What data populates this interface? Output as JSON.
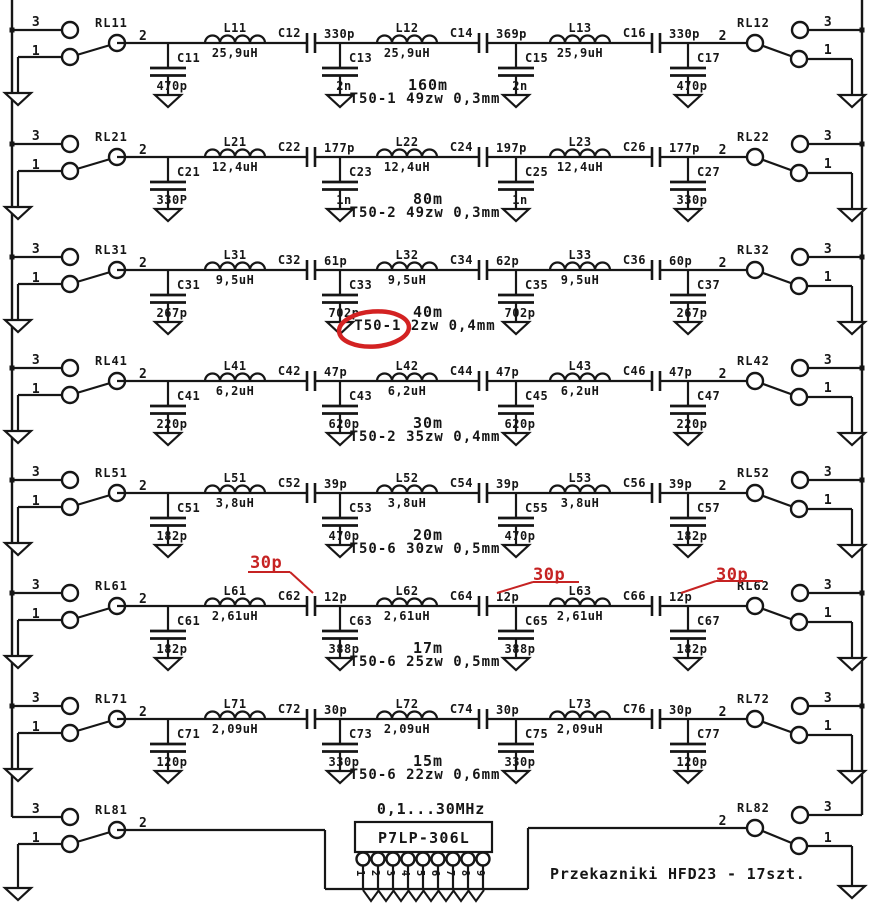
{
  "title": "P7LP-306L 7-band low-pass filter bank schematic",
  "colors": {
    "ink": "#161616",
    "red": "#c62323",
    "background": "#ffffff"
  },
  "relay_pins": {
    "top": "3",
    "common": "2",
    "bottom": "1"
  },
  "rows": [
    {
      "band": "160m",
      "winding": "T50-1 49zw 0,3mm",
      "relay_left": "RL11",
      "relay_right": "RL12",
      "shunt_caps": [
        [
          "C11",
          "470p"
        ],
        [
          "C13",
          "2n"
        ],
        [
          "C15",
          "2n"
        ],
        [
          "C17",
          "470p"
        ]
      ],
      "inductors": [
        [
          "L11",
          "25,9uH"
        ],
        [
          "L12",
          "25,9uH"
        ],
        [
          "L13",
          "25,9uH"
        ]
      ],
      "series_caps": [
        [
          "C12",
          "330p"
        ],
        [
          "C14",
          "369p"
        ],
        [
          "C16",
          "330p"
        ]
      ]
    },
    {
      "band": "80m",
      "winding": "T50-2 49zw 0,3mm",
      "relay_left": "RL21",
      "relay_right": "RL22",
      "shunt_caps": [
        [
          "C21",
          "330P"
        ],
        [
          "C23",
          "1n"
        ],
        [
          "C25",
          "1n"
        ],
        [
          "C27",
          "330p"
        ]
      ],
      "inductors": [
        [
          "L21",
          "12,4uH"
        ],
        [
          "L22",
          "12,4uH"
        ],
        [
          "L23",
          "12,4uH"
        ]
      ],
      "series_caps": [
        [
          "C22",
          "177p"
        ],
        [
          "C24",
          "197p"
        ],
        [
          "C26",
          "177p"
        ]
      ]
    },
    {
      "band": "40m",
      "winding": "T50-1  2zw 0,4mm",
      "relay_left": "RL31",
      "relay_right": "RL32",
      "shunt_caps": [
        [
          "C31",
          "267p"
        ],
        [
          "C33",
          "702p"
        ],
        [
          "C35",
          "702p"
        ],
        [
          "C37",
          "267p"
        ]
      ],
      "inductors": [
        [
          "L31",
          "9,5uH"
        ],
        [
          "L32",
          "9,5uH"
        ],
        [
          "L33",
          "9,5uH"
        ]
      ],
      "series_caps": [
        [
          "C32",
          "61p"
        ],
        [
          "C34",
          "62p"
        ],
        [
          "C36",
          "60p"
        ]
      ]
    },
    {
      "band": "30m",
      "winding": "T50-2 35zw 0,4mm",
      "relay_left": "RL41",
      "relay_right": "RL42",
      "shunt_caps": [
        [
          "C41",
          "220p"
        ],
        [
          "C43",
          "620p"
        ],
        [
          "C45",
          "620p"
        ],
        [
          "C47",
          "220p"
        ]
      ],
      "inductors": [
        [
          "L41",
          "6,2uH"
        ],
        [
          "L42",
          "6,2uH"
        ],
        [
          "L43",
          "6,2uH"
        ]
      ],
      "series_caps": [
        [
          "C42",
          "47p"
        ],
        [
          "C44",
          "47p"
        ],
        [
          "C46",
          "47p"
        ]
      ]
    },
    {
      "band": "20m",
      "winding": "T50-6 30zw 0,5mm",
      "relay_left": "RL51",
      "relay_right": "RL52",
      "shunt_caps": [
        [
          "C51",
          "182p"
        ],
        [
          "C53",
          "470p"
        ],
        [
          "C55",
          "470p"
        ],
        [
          "C57",
          "182p"
        ]
      ],
      "inductors": [
        [
          "L51",
          "3,8uH"
        ],
        [
          "L52",
          "3,8uH"
        ],
        [
          "L53",
          "3,8uH"
        ]
      ],
      "series_caps": [
        [
          "C52",
          "39p"
        ],
        [
          "C54",
          "39p"
        ],
        [
          "C56",
          "39p"
        ]
      ]
    },
    {
      "band": "17m",
      "winding": "T50-6 25zw 0,5mm",
      "relay_left": "RL61",
      "relay_right": "RL62",
      "shunt_caps": [
        [
          "C61",
          "182p"
        ],
        [
          "C63",
          "388p"
        ],
        [
          "C65",
          "388p"
        ],
        [
          "C67",
          "182p"
        ]
      ],
      "inductors": [
        [
          "L61",
          "2,61uH"
        ],
        [
          "L62",
          "2,61uH"
        ],
        [
          "L63",
          "2,61uH"
        ]
      ],
      "series_caps": [
        [
          "C62",
          "12p"
        ],
        [
          "C64",
          "12p"
        ],
        [
          "C66",
          "12p"
        ]
      ]
    },
    {
      "band": "15m",
      "winding": "T50-6 22zw 0,6mm",
      "relay_left": "RL71",
      "relay_right": "RL72",
      "shunt_caps": [
        [
          "C71",
          "120p"
        ],
        [
          "C73",
          "330p"
        ],
        [
          "C75",
          "330p"
        ],
        [
          "C77",
          "120p"
        ]
      ],
      "inductors": [
        [
          "L71",
          "2,09uH"
        ],
        [
          "L72",
          "2,09uH"
        ],
        [
          "L73",
          "2,09uH"
        ]
      ],
      "series_caps": [
        [
          "C72",
          "30p"
        ],
        [
          "C74",
          "30p"
        ],
        [
          "C76",
          "30p"
        ]
      ]
    }
  ],
  "annotations": {
    "circled": {
      "row_band": "40m",
      "text_circled": "T50-1"
    },
    "red_marks": [
      {
        "text": "30p",
        "target": "C62"
      },
      {
        "text": "30p",
        "target": "C64"
      },
      {
        "text": "30p",
        "target": "C66"
      }
    ]
  },
  "bottom": {
    "relay_left": "RL81",
    "relay_right": "RL82",
    "freq_range": "0,1...30MHz",
    "connector_label": "P7LP-306L",
    "connector_pins": [
      "1",
      "2",
      "3",
      "4",
      "5",
      "6",
      "7",
      "8",
      "9"
    ],
    "note": "Przekazniki  HFD23  - 17szt."
  }
}
